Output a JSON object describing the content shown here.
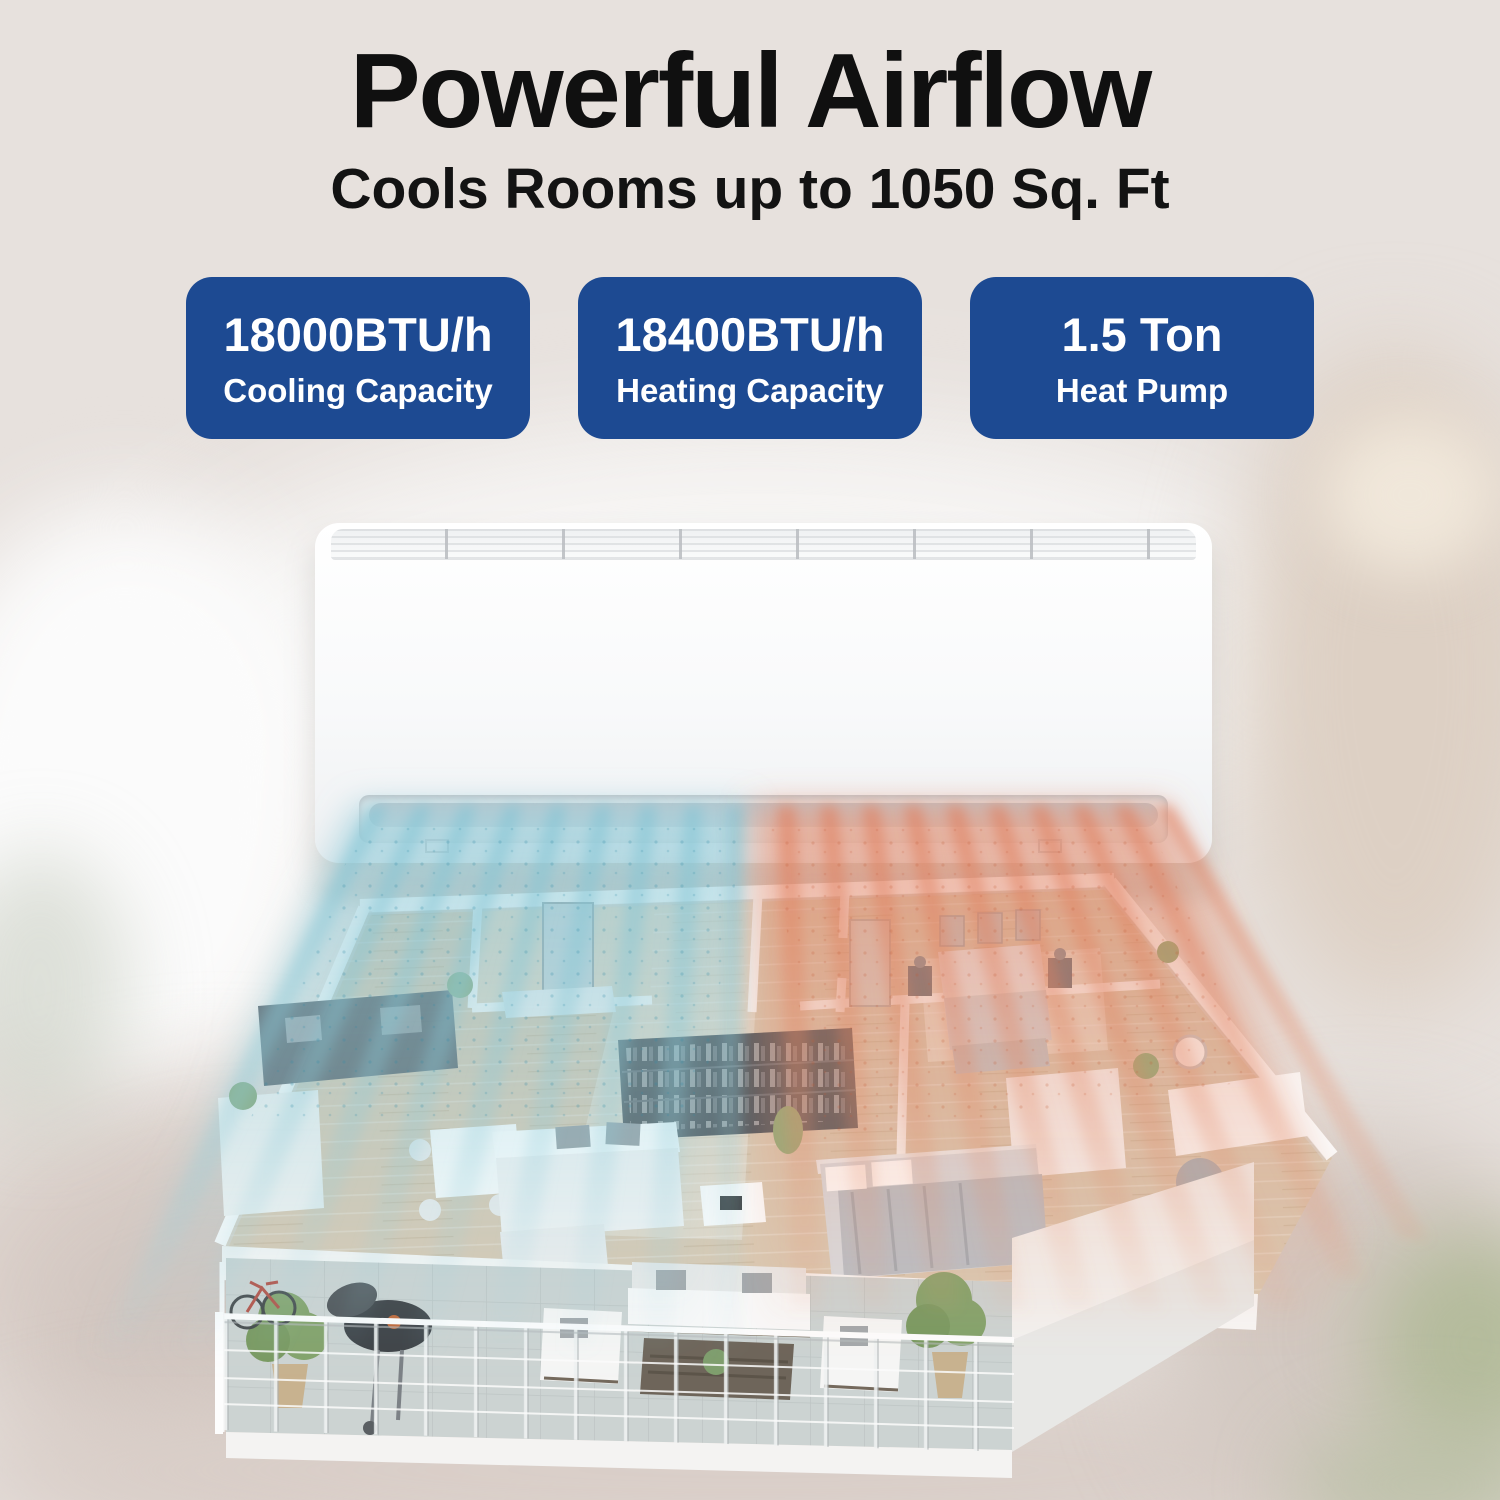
{
  "headline": "Powerful Airflow",
  "subheadline": "Cools Rooms up to 1050 Sq. Ft",
  "badges": [
    {
      "value": "18000BTU/h",
      "label": "Cooling Capacity"
    },
    {
      "value": "18400BTU/h",
      "label": "Heating Capacity"
    },
    {
      "value": "1.5 Ton",
      "label": "Heat Pump"
    }
  ],
  "colors": {
    "badge_blue": "#1d4a92",
    "badge_text": "#ffffff",
    "headline_text": "#101010",
    "background_beige": "#e7e1dd",
    "cool_airflow": "#7fc3d4",
    "warm_airflow": "#e07a58"
  },
  "scene": {
    "product": "wall-mounted mini-split indoor AC unit",
    "cool_side": "left",
    "warm_side": "right"
  }
}
